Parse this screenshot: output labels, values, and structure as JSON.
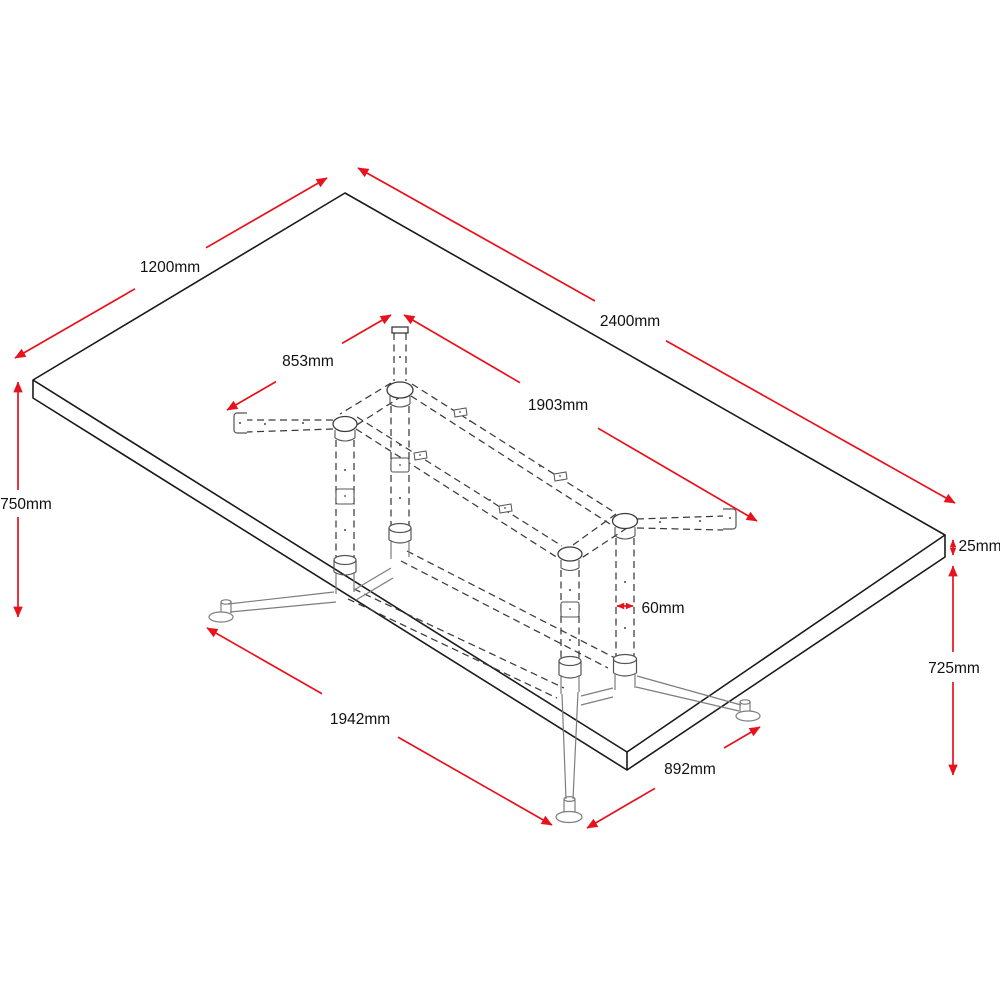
{
  "diagram": {
    "title": "Table dimensional drawing",
    "subject": "Rectangular table top on twin-pedestal tubular under-frame, perspective view with hidden (dashed) frame lines",
    "units": "mm",
    "colors": {
      "outline": "#1a1a1a",
      "hidden_lines": "#3b3b3b",
      "visible_base": "#7d7d7d",
      "dimension_arrows": "#e8121c",
      "label_text": "#111111",
      "background": "#ffffff"
    },
    "dimensions": {
      "tabletop_width": {
        "label": "1200mm",
        "value": 1200,
        "measures": "table top width (short edge)"
      },
      "tabletop_length": {
        "label": "2400mm",
        "value": 2400,
        "measures": "table top length (long edge)"
      },
      "frame_width": {
        "label": "853mm",
        "value": 853,
        "measures": "under-frame width"
      },
      "frame_length": {
        "label": "1903mm",
        "value": 1903,
        "measures": "under-frame length"
      },
      "overall_height": {
        "label": "750mm",
        "value": 750,
        "measures": "overall table height"
      },
      "top_thickness": {
        "label": "25mm",
        "value": 25,
        "measures": "table top thickness"
      },
      "clearance_height": {
        "label": "725mm",
        "value": 725,
        "measures": "height under table top"
      },
      "column_diameter": {
        "label": "60mm",
        "value": 60,
        "measures": "leg column diameter"
      },
      "base_length": {
        "label": "1942mm",
        "value": 1942,
        "measures": "foot print length"
      },
      "base_width": {
        "label": "892mm",
        "value": 892,
        "measures": "foot print width"
      }
    }
  }
}
